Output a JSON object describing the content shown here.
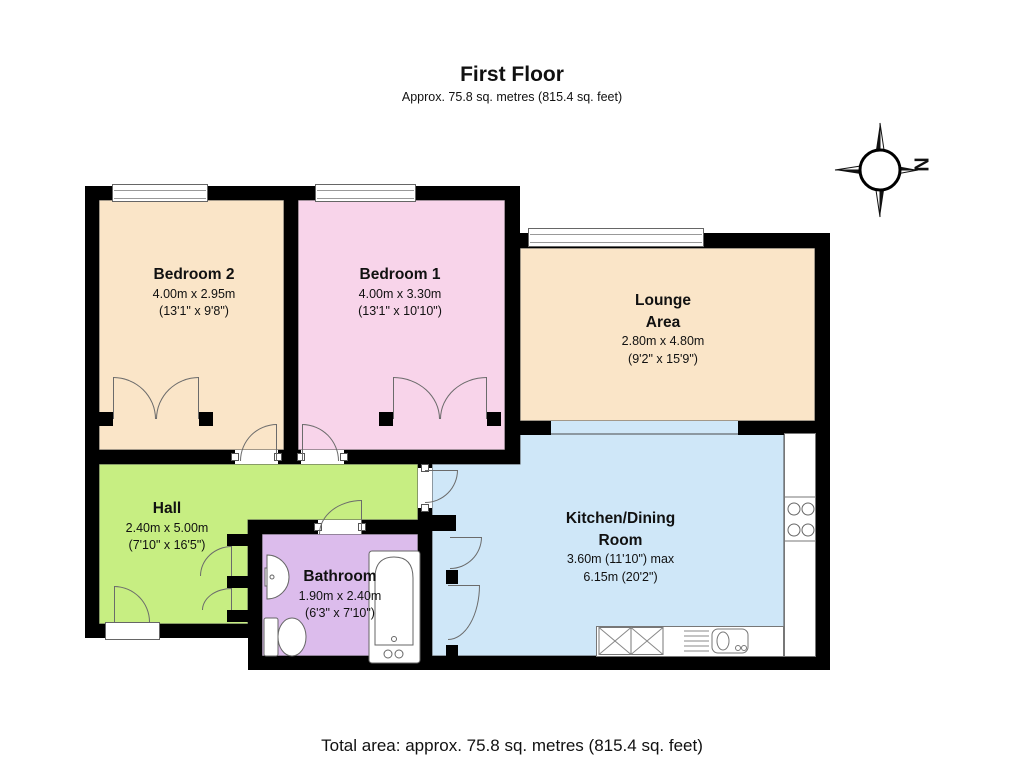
{
  "title": "First Floor",
  "subtitle": "Approx.  75.8 sq. metres (815.4 sq. feet)",
  "total_area": "Total area: approx.  75.8 sq. metres (815.4 sq. feet)",
  "compass": {
    "north_label": "N"
  },
  "colors": {
    "wall": "#000000",
    "bedroom2_floor": "#fae5c8",
    "bedroom1_floor": "#f8d4ea",
    "lounge_floor": "#fae5c8",
    "hall_floor": "#c7ee82",
    "bathroom_floor": "#dcbcec",
    "kitchen_floor": "#cfe7f8"
  },
  "rooms": {
    "bedroom2": {
      "name": "Bedroom 2",
      "metric": "4.00m x 2.95m",
      "imperial": "(13'1\" x 9'8\")"
    },
    "bedroom1": {
      "name": "Bedroom 1",
      "metric": "4.00m x 3.30m",
      "imperial": "(13'1\" x 10'10\")"
    },
    "lounge": {
      "name_line1": "Lounge",
      "name_line2": "Area",
      "metric": "2.80m x 4.80m",
      "imperial": "(9'2\" x 15'9\")"
    },
    "hall": {
      "name": "Hall",
      "metric": "2.40m x 5.00m",
      "imperial": "(7'10\" x 16'5\")"
    },
    "bathroom": {
      "name": "Bathroom",
      "metric": "1.90m x 2.40m",
      "imperial": "(6'3\" x 7'10\")"
    },
    "kitchen": {
      "name_line1": "Kitchen/Dining",
      "name_line2": "Room",
      "metric": "3.60m (11'10\") max",
      "imperial": "6.15m (20'2\")"
    }
  }
}
